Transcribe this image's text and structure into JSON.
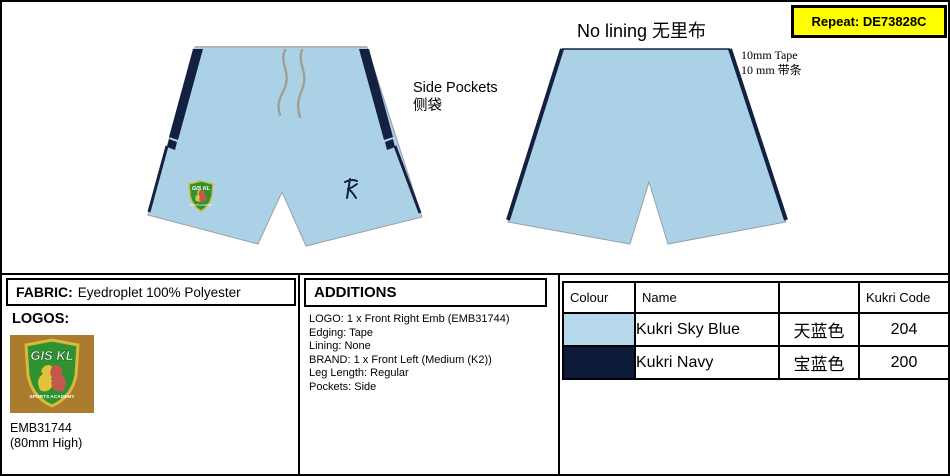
{
  "annotations": {
    "repeat": "Repeat: DE73828C",
    "no_lining": "No lining 无里布",
    "tape_note_line1": "10mm Tape",
    "tape_note_line2": "10 mm 带条",
    "side_pockets_line1": "Side Pockets",
    "side_pockets_line2": "侧袋"
  },
  "fabric": {
    "label": "FABRIC:",
    "value": "Eyedroplet 100% Polyester"
  },
  "logos": {
    "label": "LOGOS:",
    "badge_title": "GIS KL",
    "badge_subtitle": "SPORTS ACADEMY",
    "code": "EMB31744",
    "size": "(80mm High)"
  },
  "additions": {
    "title": "ADDITIONS",
    "items": [
      "LOGO: 1 x Front Right Emb (EMB31744)",
      "Edging: Tape",
      "Lining: None",
      "BRAND: 1 x Front Left (Medium (K2))",
      "Leg Length: Regular",
      "Pockets: Side"
    ]
  },
  "colour_table": {
    "headers": [
      "Colour",
      "Name",
      "",
      "Kukri Code"
    ],
    "rows": [
      {
        "swatch": "#b5d8ea",
        "name": "Kukri Sky Blue",
        "chinese": "天蓝色",
        "code": "204"
      },
      {
        "swatch": "#0d1b38",
        "name": "Kukri Navy",
        "chinese": "宝蓝色",
        "code": "200"
      }
    ]
  },
  "colors": {
    "sky_blue": "#abd1e7",
    "navy": "#13203f",
    "drawstring": "#a39e93",
    "repeat_bg": "#ffff00",
    "badge_bg": "#ab7c2d",
    "shield_green": "#2f9231",
    "shield_border": "#d8b93c",
    "lion_gold": "#e2c23a",
    "lion_red": "#c4584a"
  }
}
